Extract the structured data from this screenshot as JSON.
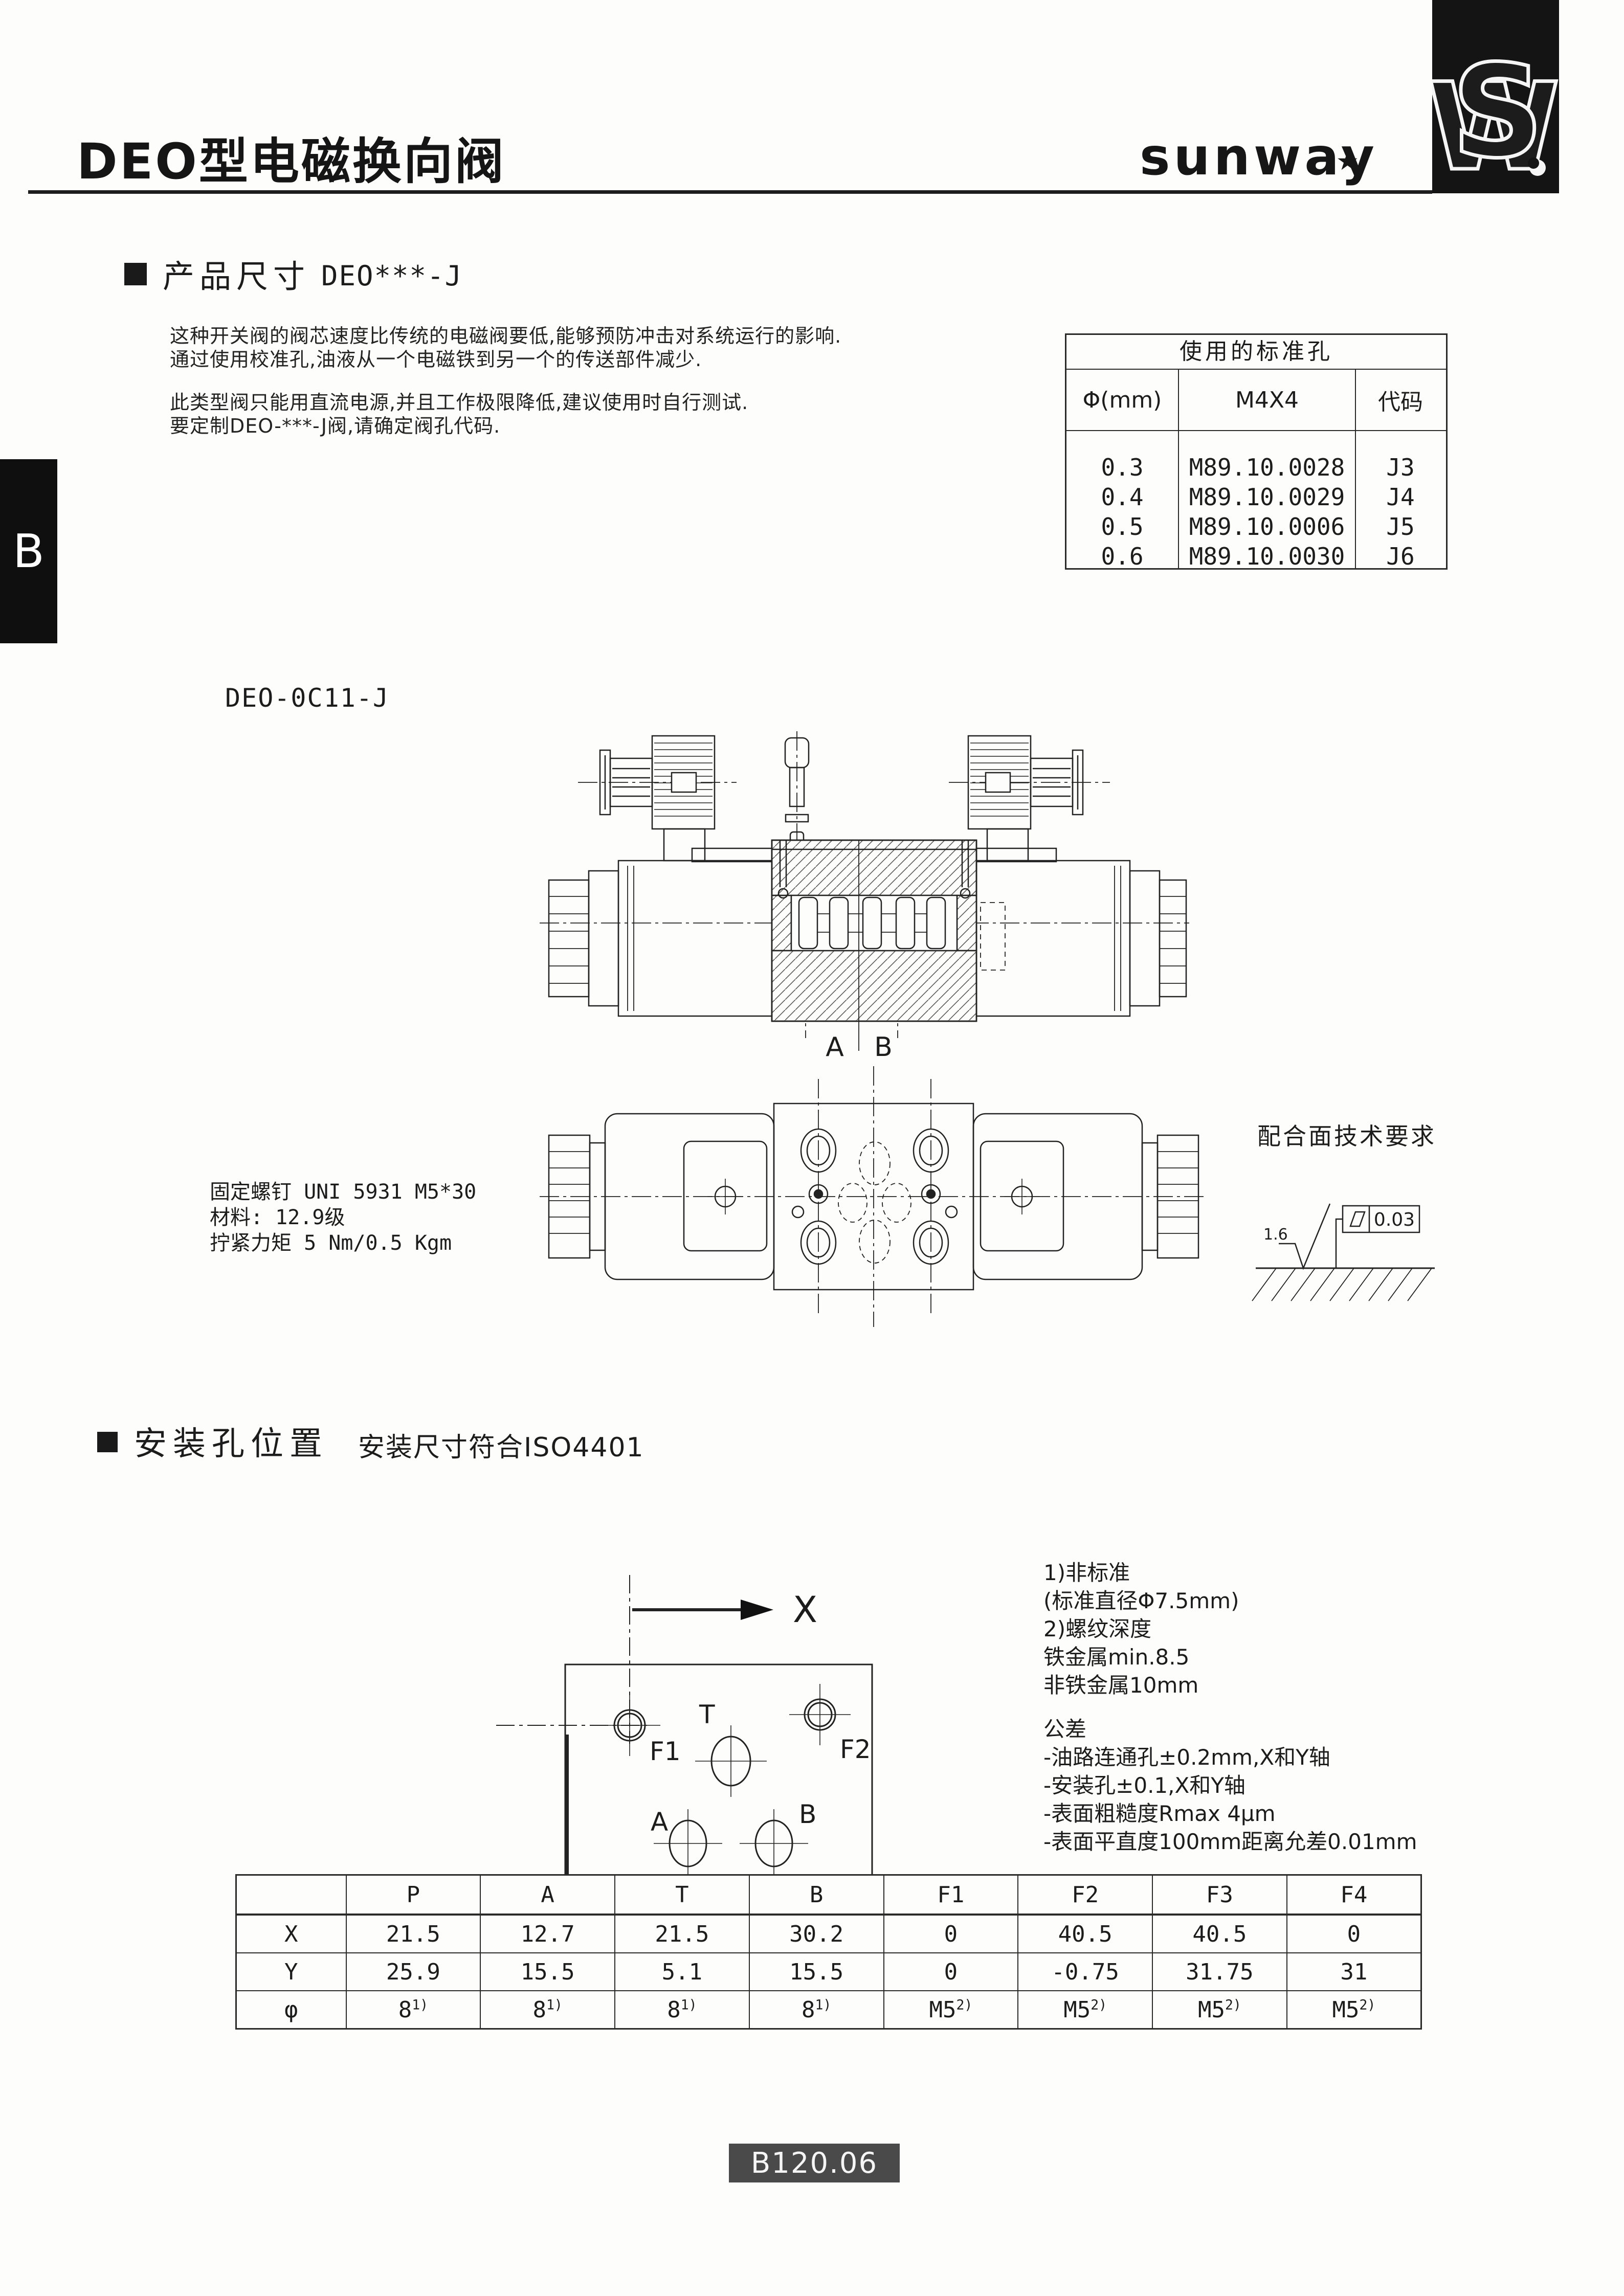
{
  "header": {
    "title": "DEO型电磁换向阀",
    "brand": "sunway",
    "side_tab": "B"
  },
  "section1": {
    "title": "产品尺寸",
    "subtitle": "DEO***-J",
    "para1": [
      "这种开关阀的阀芯速度比传统的电磁阀要低,能够预防冲击对系统运行的影响.",
      "通过使用校准孔,油液从一个电磁铁到另一个的传送部件减少."
    ],
    "para2": [
      "此类型阀只能用直流电源,并且工作极限降低,建议使用时自行测试.",
      "要定制DEO-***-J阀,请确定阀孔代码."
    ]
  },
  "std_holes_table": {
    "title": "使用的标准孔",
    "headers": [
      "Φ(mm)",
      "M4X4",
      "代码"
    ],
    "rows": [
      [
        "0.3",
        "M89.10.0028",
        "J3"
      ],
      [
        "0.4",
        "M89.10.0029",
        "J4"
      ],
      [
        "0.5",
        "M89.10.0006",
        "J5"
      ],
      [
        "0.6",
        "M89.10.0030",
        "J6"
      ]
    ]
  },
  "drawing1": {
    "label": "DEO-0C11-J",
    "port_a": "A",
    "port_b": "B"
  },
  "drawing2": {
    "notes": [
      "固定螺钉 UNI 5931 M5*30",
      "材料: 12.9级",
      "拧紧力矩 5 Nm/0.5 Kgm"
    ]
  },
  "surface_req": {
    "title": "配合面技术要求",
    "roughness": "1.6",
    "flatness": "0.03"
  },
  "section2": {
    "title": "安装孔位置",
    "subtitle": "安装尺寸符合ISO4401"
  },
  "mounting": {
    "axis_x": "X",
    "axis_y": "Y",
    "hole_labels": {
      "f1": "F1",
      "t": "T",
      "f2": "F2",
      "a": "A",
      "b": "B",
      "p": "P",
      "f4": "F4",
      "f3": "F3"
    }
  },
  "notes1": [
    "1)非标准",
    "(标准直径Φ7.5mm)",
    "2)螺纹深度",
    "铁金属min.8.5",
    "非铁金属10mm"
  ],
  "notes2": [
    "公差",
    "-油路连通孔±0.2mm,X和Y轴",
    "-安装孔±0.1,X和Y轴",
    "-表面粗糙度Rmax 4μm",
    "-表面平直度100mm距离允差0.01mm"
  ],
  "dimensions_table": {
    "corner": "",
    "columns": [
      "P",
      "A",
      "T",
      "B",
      "F1",
      "F2",
      "F3",
      "F4"
    ],
    "rows": [
      {
        "label": "X",
        "values": [
          "21.5",
          "12.7",
          "21.5",
          "30.2",
          "0",
          "40.5",
          "40.5",
          "0"
        ]
      },
      {
        "label": "Y",
        "values": [
          "25.9",
          "15.5",
          "5.1",
          "15.5",
          "0",
          "-0.75",
          "31.75",
          "31"
        ]
      },
      {
        "label": "φ",
        "values": [
          "8^1)",
          "8^1)",
          "8^1)",
          "8^1)",
          "M5^2)",
          "M5^2)",
          "M5^2)",
          "M5^2)"
        ]
      }
    ]
  },
  "footer": {
    "page_code": "B120.06"
  }
}
